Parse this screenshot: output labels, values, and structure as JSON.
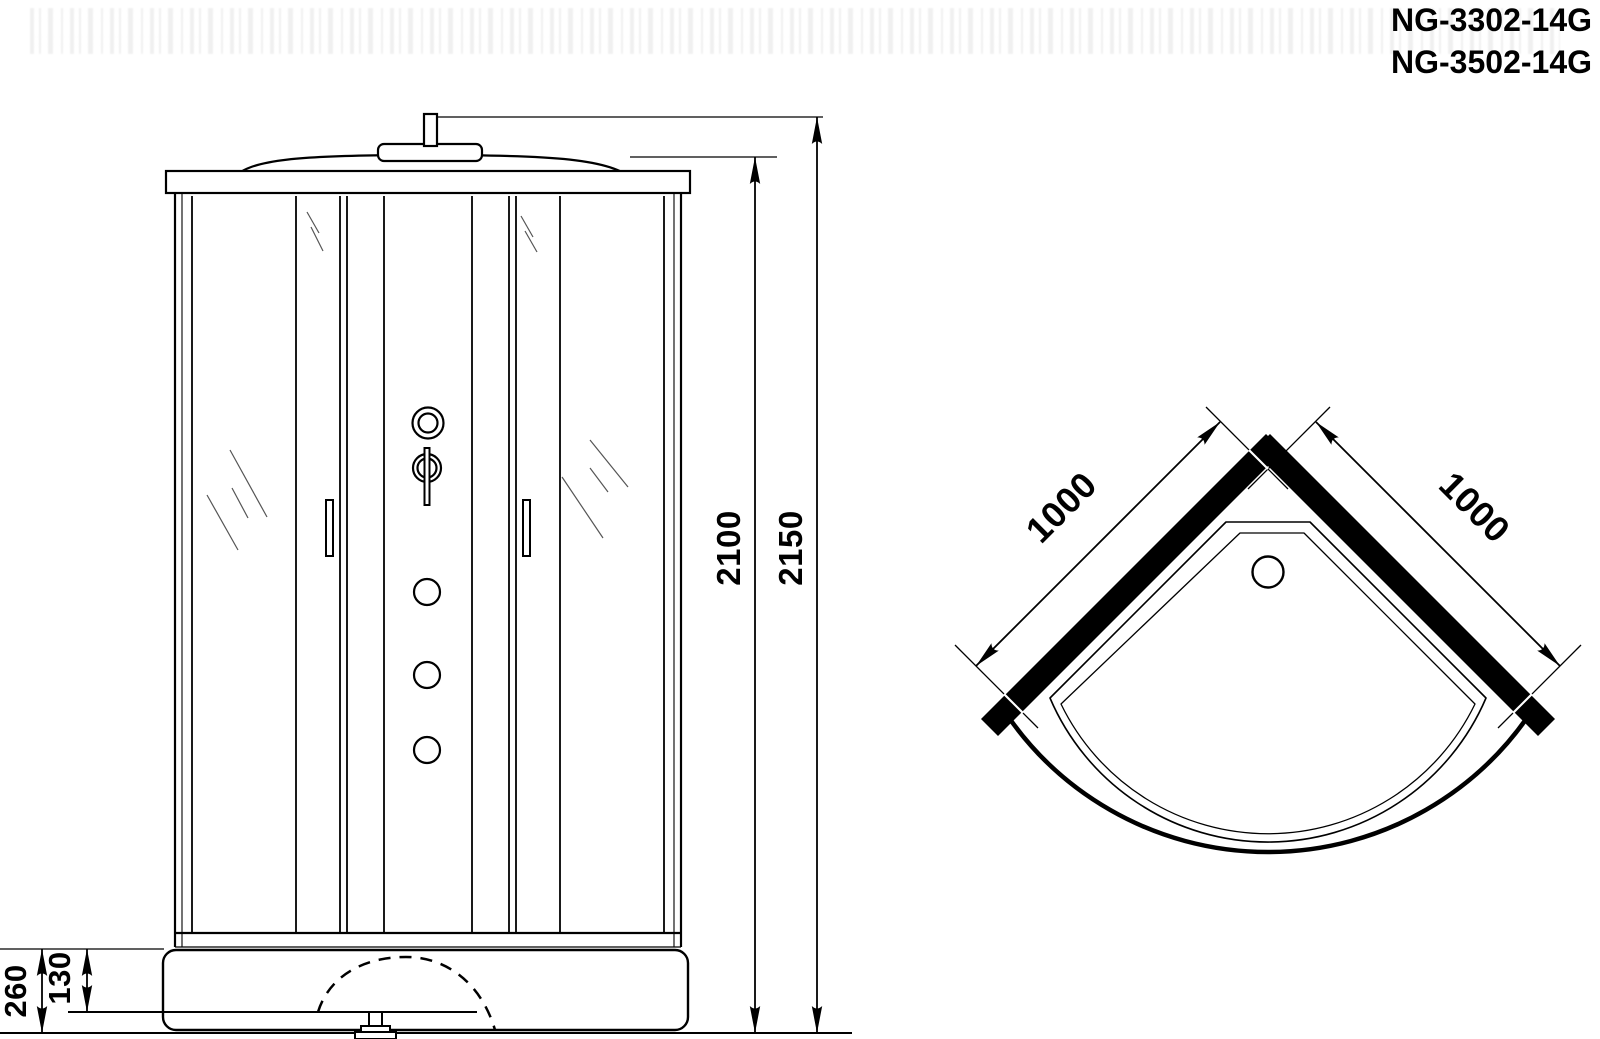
{
  "models": [
    "NG-3302-14G",
    "NG-3502-14G"
  ],
  "front_view_dimensions": {
    "cabin_height": "2100",
    "total_height": "2150",
    "tray_height": "260",
    "drain_level": "130"
  },
  "plan_view_dimensions": {
    "left_wall": "1000",
    "right_wall": "1000"
  },
  "colors": {
    "ink": "#000000",
    "background": "#ffffff",
    "glass_hatch": "#555555"
  }
}
